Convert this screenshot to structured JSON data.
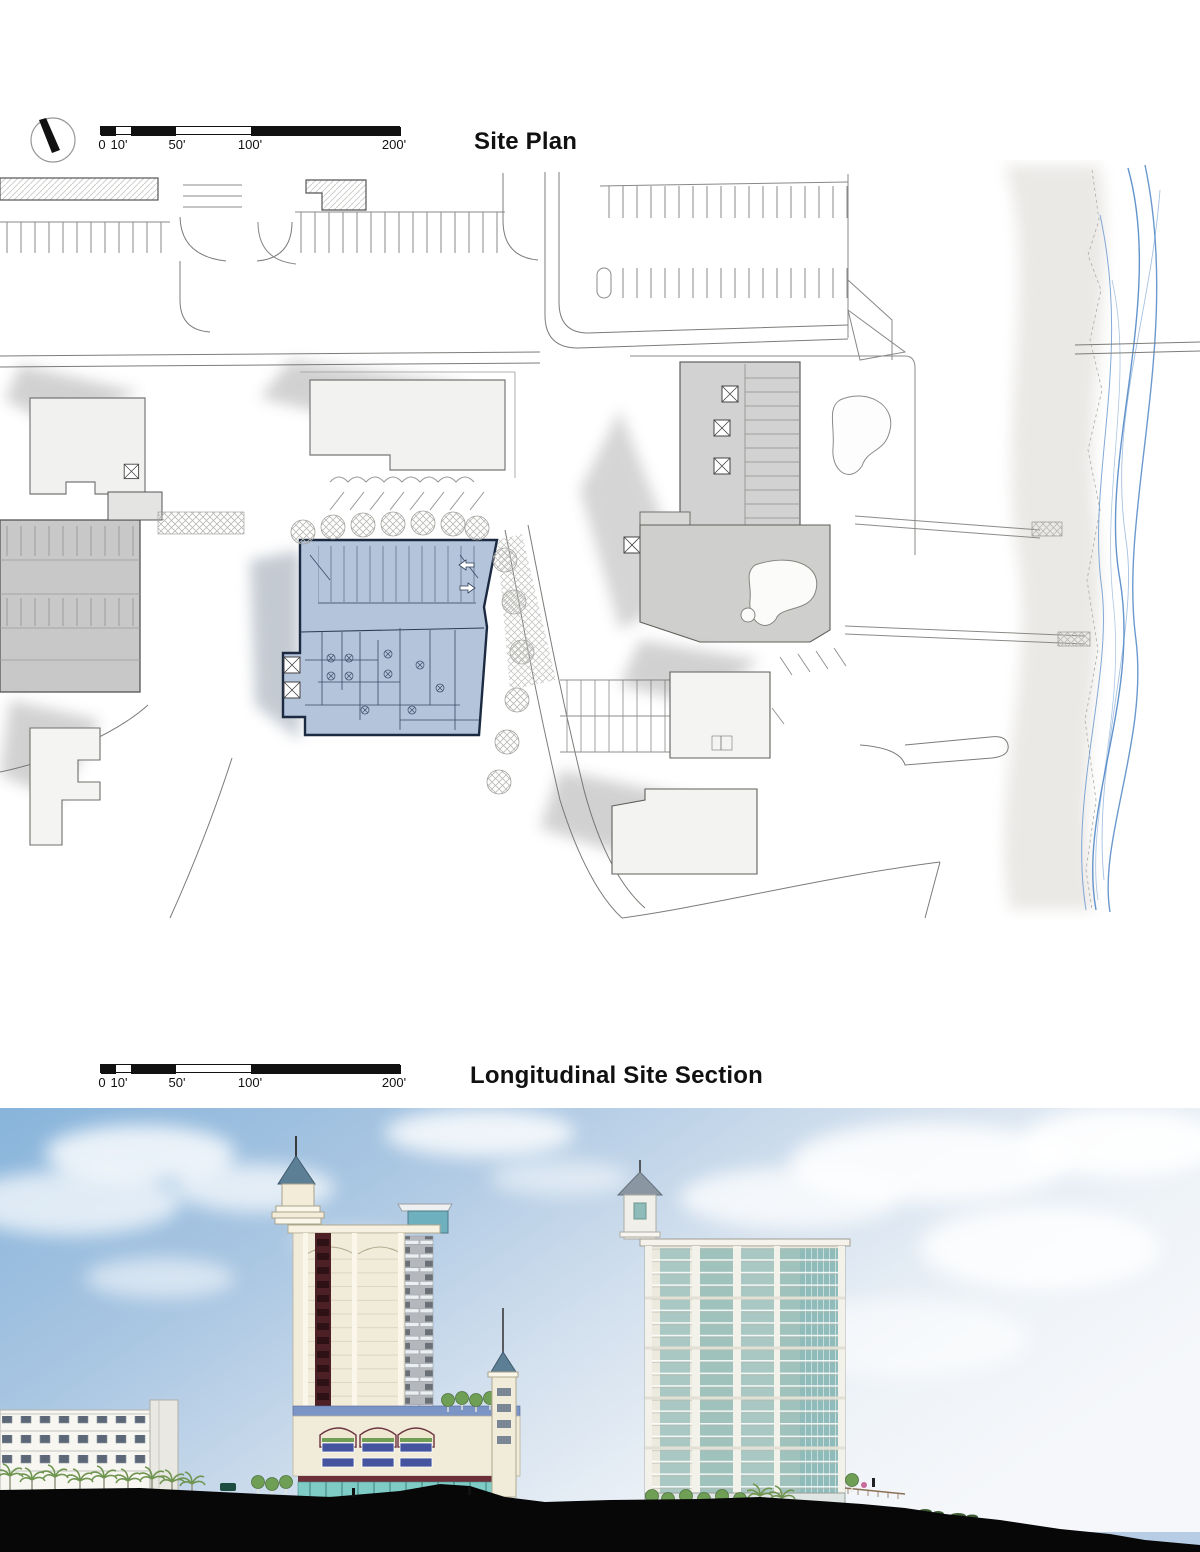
{
  "page": {
    "background": "#ffffff"
  },
  "site_plan": {
    "title": "Site Plan",
    "north_arrow_icon": "north-arrow",
    "scale_bar": {
      "unit": "feet",
      "labels": [
        "0",
        "10'",
        "50'",
        "100'",
        "200'"
      ]
    },
    "colors": {
      "proposed_building_fill": "#b4c4db",
      "proposed_building_outline": "#1b2a40",
      "existing_hotel_fill": "#d2d2d2",
      "parking_garage_fill": "#c8c8c8",
      "light_building_fill": "#f2f2f0",
      "line_work": "#777777",
      "shoreline_blue": "#5b8ec9",
      "beach_sand": "#e2e0dc"
    }
  },
  "section": {
    "title": "Longitudinal Site Section",
    "scale_bar": {
      "unit": "feet",
      "labels": [
        "0",
        "10'",
        "50'",
        "100'",
        "200'"
      ]
    },
    "colors": {
      "sky_top": "#88b4db",
      "sky_horizon": "#f5f7fa",
      "ocean": "#b7cde6",
      "ground_silhouette": "#070707",
      "tower_wall": "#f1ecd9",
      "tower_accent_stripe": "#4d2026",
      "tower_roof": "#5d7f95",
      "podium_band": "#7a94c6",
      "podium_window": "#44549f",
      "storefront_glass": "#7fccc6",
      "condo_wall": "#eceade",
      "condo_glass": "#8fbcba",
      "foliage": "#6f9e55"
    }
  }
}
